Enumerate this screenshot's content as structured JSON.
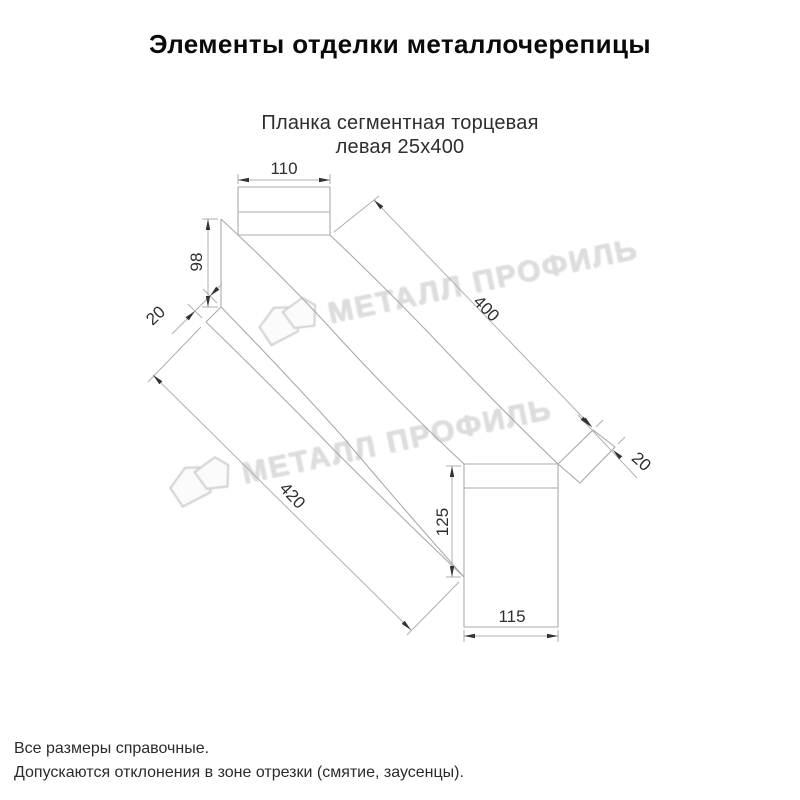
{
  "header": {
    "title": "Элементы отделки металлочерепицы"
  },
  "subtitle": {
    "line1": "Планка сегментная торцевая",
    "line2": "левая 25х400"
  },
  "watermark": {
    "text": "МЕТАЛЛ ПРОФИЛЬ",
    "color": "#dddddd"
  },
  "drawing": {
    "type": "isometric technical drawing of left segment end strip",
    "line_color": "#a8abab",
    "arrow_color": "#333333",
    "dimensions": {
      "top_flange_width": "110",
      "far_end_height": "98",
      "far_hem_width": "20",
      "top_edge_length": "400",
      "end_tab_width": "20",
      "bottom_edge_length": "420",
      "section_height": "125",
      "section_width": "115"
    }
  },
  "footer": {
    "line1": "Все размеры справочные.",
    "line2": "Допускаются отклонения в зоне отрезки (смятие, заусенцы)."
  }
}
